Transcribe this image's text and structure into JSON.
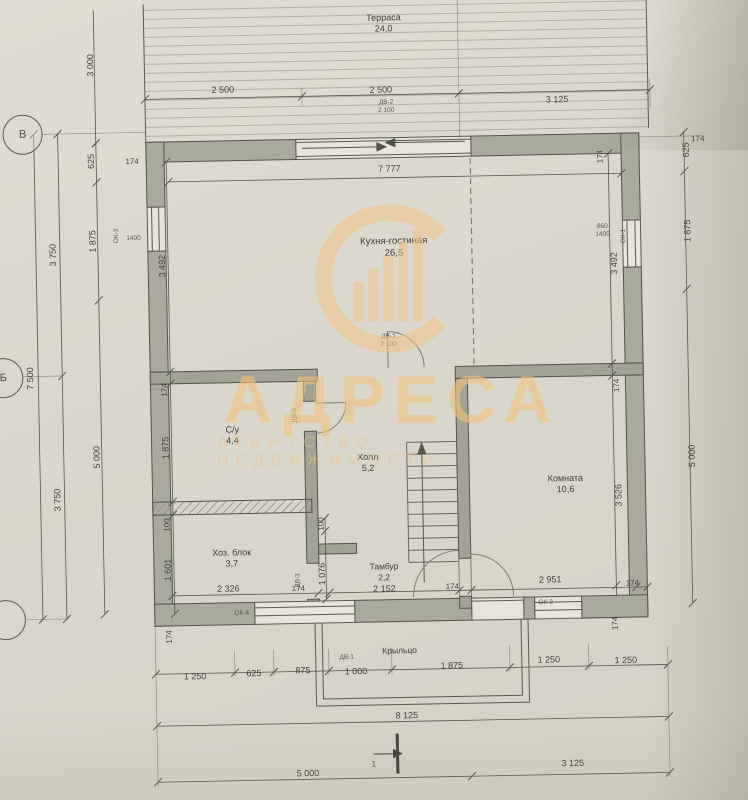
{
  "watermark": {
    "brand": "АДРЕСА",
    "tagline": "АГЕНТСТВО НЕДВИЖИМОСТИ",
    "color": "#eec37e"
  },
  "axis_markers": [
    {
      "label": "В",
      "x": 27,
      "y": 128
    },
    {
      "label": "Б",
      "x": 3,
      "y": 371
    },
    {
      "label": "",
      "x": 1,
      "y": 613
    }
  ],
  "rooms": [
    {
      "name": "Терраса",
      "area": "24,0",
      "x": 390,
      "y": 24,
      "fs": 9
    },
    {
      "name": "Кухня-гостиная",
      "area": "26,5",
      "x": 396,
      "y": 248,
      "fs": 9.5
    },
    {
      "name": "С/у",
      "area": "4,4",
      "x": 231,
      "y": 433,
      "fs": 9
    },
    {
      "name": "Холл",
      "area": "5,2",
      "x": 366,
      "y": 463,
      "fs": 9
    },
    {
      "name": "Хоз. блок",
      "area": "3,7",
      "x": 228,
      "y": 556,
      "fs": 9
    },
    {
      "name": "Комната",
      "area": "10,6",
      "x": 563,
      "y": 488,
      "fs": 9
    },
    {
      "name": "Тамбур",
      "area": "2,2",
      "x": 380,
      "y": 572,
      "fs": 8.5
    },
    {
      "name": "Крыльцо",
      "area": "",
      "x": 394,
      "y": 651,
      "fs": 8.5
    }
  ],
  "dims": [
    {
      "t": "2 500",
      "x": 228,
      "y": 87
    },
    {
      "t": "2 500",
      "x": 386,
      "y": 90
    },
    {
      "t": "3 125",
      "x": 562,
      "y": 103
    },
    {
      "t": "3 000",
      "x": 96,
      "y": 60,
      "r": -90
    },
    {
      "t": "7 777",
      "x": 393,
      "y": 169
    },
    {
      "t": "7 500",
      "x": 30,
      "y": 372,
      "r": -90
    },
    {
      "t": "3 750",
      "x": 55,
      "y": 249,
      "r": -90
    },
    {
      "t": "3 750",
      "x": 55,
      "y": 494,
      "r": -90
    },
    {
      "t": "625",
      "x": 95,
      "y": 156,
      "r": -90
    },
    {
      "t": "1 875",
      "x": 95,
      "y": 236,
      "r": -90
    },
    {
      "t": "5 000",
      "x": 95,
      "y": 452,
      "r": -90
    },
    {
      "t": "174",
      "x": 136,
      "y": 157,
      "fs": 8
    },
    {
      "t": "3 492",
      "x": 164,
      "y": 262,
      "r": -90
    },
    {
      "t": "174",
      "x": 164,
      "y": 386,
      "r": -90,
      "fs": 8
    },
    {
      "t": "1 875",
      "x": 164,
      "y": 444,
      "r": -90
    },
    {
      "t": "100",
      "x": 164,
      "y": 521,
      "r": -90,
      "fs": 8
    },
    {
      "t": "1 601",
      "x": 164,
      "y": 566,
      "r": -90
    },
    {
      "t": "174",
      "x": 164,
      "y": 633,
      "r": -90,
      "fs": 8
    },
    {
      "t": "174",
      "x": 604,
      "y": 161,
      "r": -90,
      "fs": 8
    },
    {
      "t": "3 492",
      "x": 616,
      "y": 268,
      "r": -90
    },
    {
      "t": "174",
      "x": 616,
      "y": 390,
      "r": -90,
      "fs": 8
    },
    {
      "t": "3 526",
      "x": 616,
      "y": 500,
      "r": -90
    },
    {
      "t": "625",
      "x": 690,
      "y": 156,
      "r": -90
    },
    {
      "t": "1 875",
      "x": 690,
      "y": 237,
      "r": -90
    },
    {
      "t": "5 000",
      "x": 690,
      "y": 462,
      "r": -90
    },
    {
      "t": "174",
      "x": 702,
      "y": 145,
      "fs": 8
    },
    {
      "t": "2 326",
      "x": 224,
      "y": 586
    },
    {
      "t": "174",
      "x": 294,
      "y": 587,
      "fs": 8
    },
    {
      "t": "2 152",
      "x": 380,
      "y": 589
    },
    {
      "t": "174",
      "x": 448,
      "y": 588,
      "fs": 8
    },
    {
      "t": "2 951",
      "x": 546,
      "y": 583
    },
    {
      "t": "174",
      "x": 628,
      "y": 588,
      "fs": 8
    },
    {
      "t": "100",
      "x": 318,
      "y": 523,
      "r": -90,
      "fs": 8
    },
    {
      "t": "1 076",
      "x": 318,
      "y": 573,
      "r": -90
    },
    {
      "t": "1 250",
      "x": 189,
      "y": 673
    },
    {
      "t": "625",
      "x": 248,
      "y": 671
    },
    {
      "t": "875",
      "x": 297,
      "y": 669
    },
    {
      "t": "1 000",
      "x": 350,
      "y": 671
    },
    {
      "t": "1 875",
      "x": 446,
      "y": 667
    },
    {
      "t": "1 250",
      "x": 543,
      "y": 663
    },
    {
      "t": "1 250",
      "x": 620,
      "y": 665
    },
    {
      "t": "174",
      "x": 610,
      "y": 628,
      "r": -90,
      "fs": 8
    },
    {
      "t": "8 125",
      "x": 400,
      "y": 716
    },
    {
      "t": "5 000",
      "x": 300,
      "y": 772
    },
    {
      "t": "3 125",
      "x": 565,
      "y": 767
    },
    {
      "t": "1",
      "x": 366,
      "y": 764,
      "fs": 8
    }
  ],
  "tags": [
    {
      "t": "ДВ-2",
      "x": 391,
      "y": 103
    },
    {
      "t": "2 100",
      "x": 391,
      "y": 111
    },
    {
      "t": "ДВ-1",
      "x": 389,
      "y": 337
    },
    {
      "t": "2 100",
      "x": 389,
      "y": 345
    },
    {
      "t": "ДВ-3",
      "x": 294,
      "y": 414,
      "r": -90
    },
    {
      "t": "ДВ-3",
      "x": 294,
      "y": 579,
      "r": -90
    },
    {
      "t": "ОК-1",
      "x": 626,
      "y": 241,
      "r": -90
    },
    {
      "t": "860",
      "x": 605,
      "y": 231
    },
    {
      "t": "1400",
      "x": 605,
      "y": 239
    },
    {
      "t": "ОК-3",
      "x": 119,
      "y": 231,
      "r": -90
    },
    {
      "t": "1400",
      "x": 136,
      "y": 234
    },
    {
      "t": "ОК-4",
      "x": 237,
      "y": 611
    },
    {
      "t": "ДВ-1",
      "x": 341,
      "y": 657
    },
    {
      "t": "ОК-2",
      "x": 541,
      "y": 606
    }
  ]
}
